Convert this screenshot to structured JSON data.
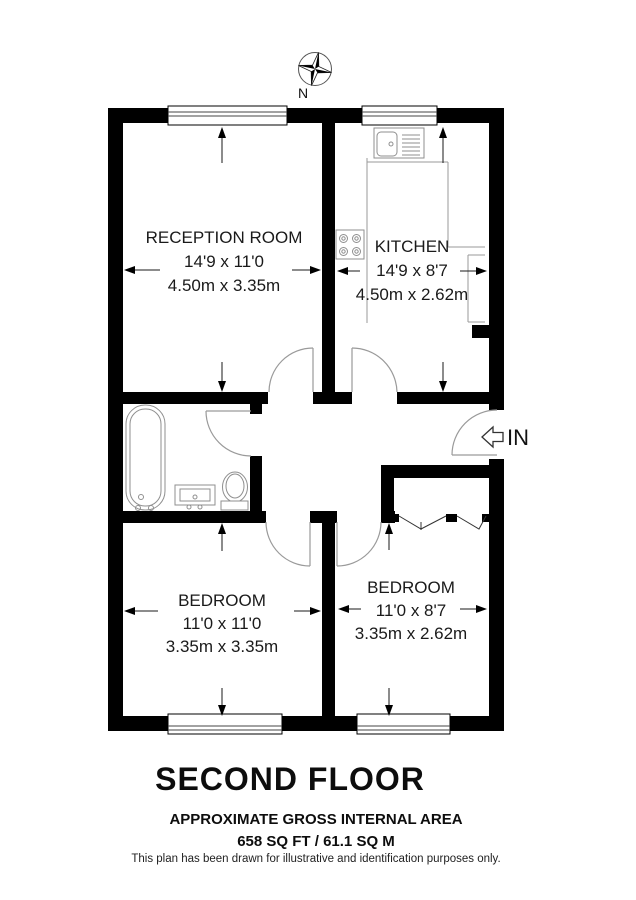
{
  "plan": {
    "compass_label": "N",
    "entrance_label": "IN",
    "rooms": {
      "reception": {
        "name": "RECEPTION ROOM",
        "imperial": "14'9 x 11'0",
        "metric": "4.50m x 3.35m"
      },
      "kitchen": {
        "name": "KITCHEN",
        "imperial": "14'9 x 8'7",
        "metric": "4.50m x 2.62m"
      },
      "bedroom_left": {
        "name": "BEDROOM",
        "imperial": "11'0 x 11'0",
        "metric": "3.35m x 3.35m"
      },
      "bedroom_right": {
        "name": "BEDROOM",
        "imperial": "11'0 x 8'7",
        "metric": "3.35m x 2.62m"
      }
    }
  },
  "footer": {
    "floor_title": "SECOND FLOOR",
    "area_heading": "APPROXIMATE GROSS INTERNAL AREA",
    "area_value": "658 SQ FT / 61.1 SQ M",
    "disclaimer": "This plan has been drawn for illustrative and identification purposes only."
  },
  "colors": {
    "wall": "#000000",
    "background": "#ffffff",
    "fixture_line": "#8f8f8f",
    "text": "#1a1a1a"
  }
}
